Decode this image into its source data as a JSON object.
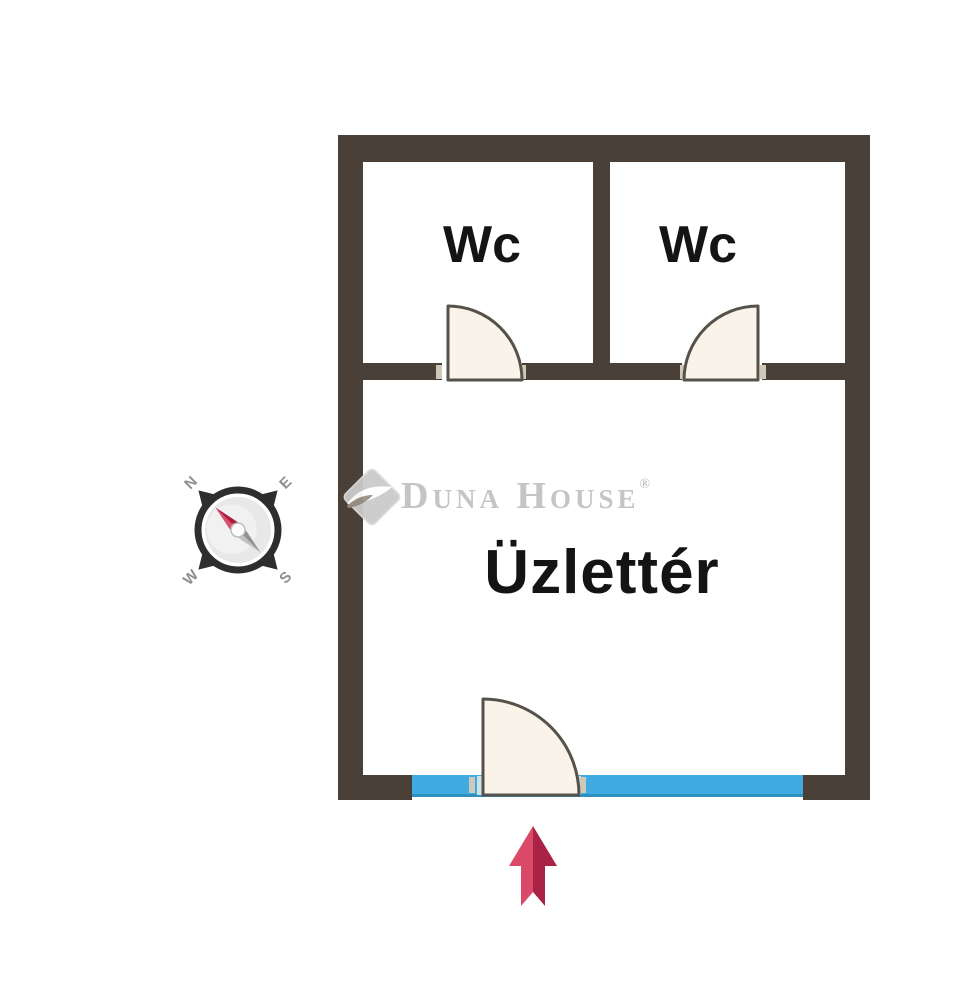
{
  "floor_plan": {
    "rooms": [
      {
        "label": "Wc"
      },
      {
        "label": "Wc"
      },
      {
        "label": "Üzlettér"
      }
    ],
    "colors": {
      "wall": "#4b4037",
      "door_fill": "#faf3e9",
      "door_stroke": "#56524a",
      "storefront_glass": "#41abe1",
      "glass_behind_door": "#cfe2e8",
      "door_jamb": "#cfc9bc"
    }
  },
  "compass": {
    "letters": {
      "n": "N",
      "e": "E",
      "s": "S",
      "w": "W"
    },
    "needle_north_color": "#b01c40",
    "needle_south_color": "#909090",
    "ring_color": "#2e2e2e"
  },
  "entrance_arrow": {
    "direction": "up",
    "color_light": "#da4a68",
    "color_dark": "#aa2346"
  },
  "watermark": {
    "brand": "Duna House",
    "registered_mark": "®",
    "color": "#c5c5c5"
  }
}
